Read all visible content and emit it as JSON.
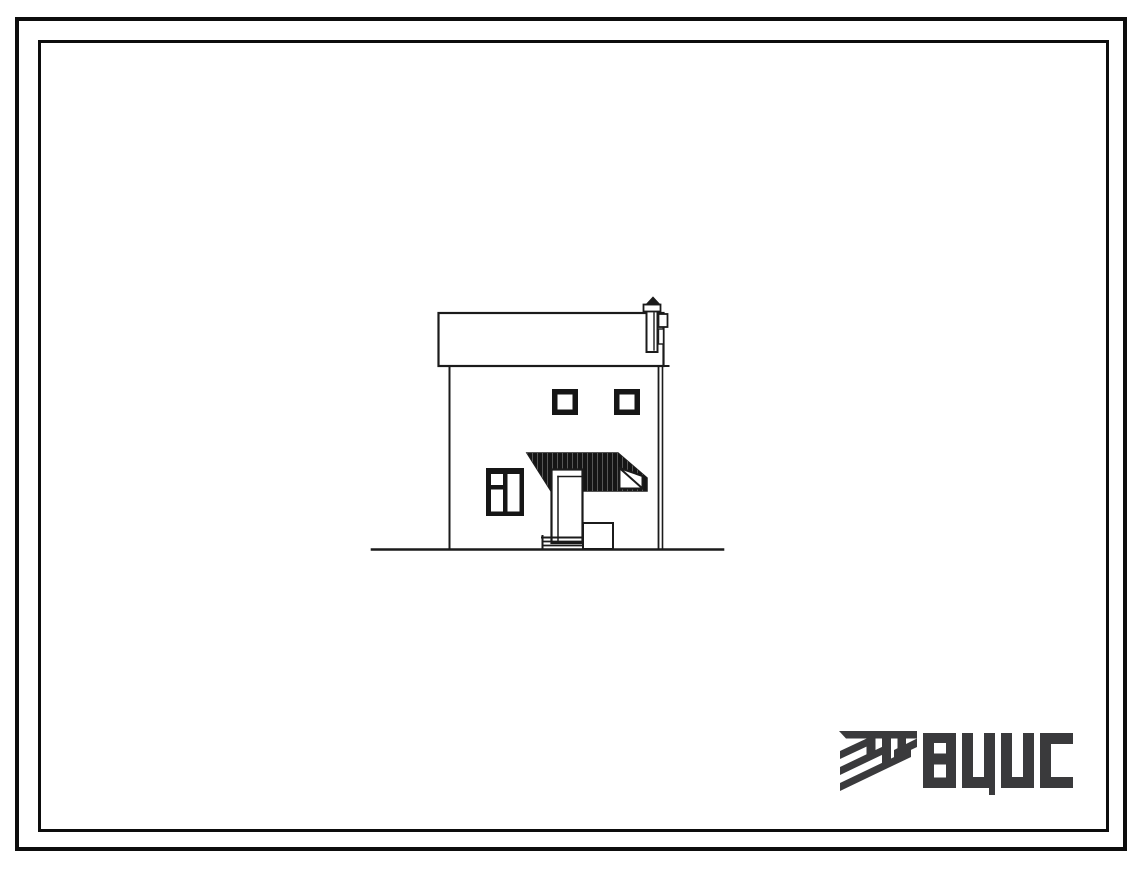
{
  "document": {
    "kind": "scanned standard-design sheet with house side elevation drawing",
    "background_color": "#ffffff",
    "ink_color": "#1b1b1b"
  },
  "frame": {
    "outer_border_color": "#0d0d0d",
    "inner_border_color": "#0d0d0d"
  },
  "drawing": {
    "name": "house-side-elevation",
    "features": [
      "flat parapet roof band",
      "roof vent chimney with cap",
      "two small square upper windows",
      "three-pane lower window",
      "dark hatched entrance canopy",
      "canopy side railing with diagonal brace",
      "entrance door",
      "porch steps",
      "low side block",
      "ground line"
    ]
  },
  "logo": {
    "text": "ВЦИС",
    "color": "#3a3a3c",
    "emblem_icon": "diagonal-hatched-monogram"
  }
}
